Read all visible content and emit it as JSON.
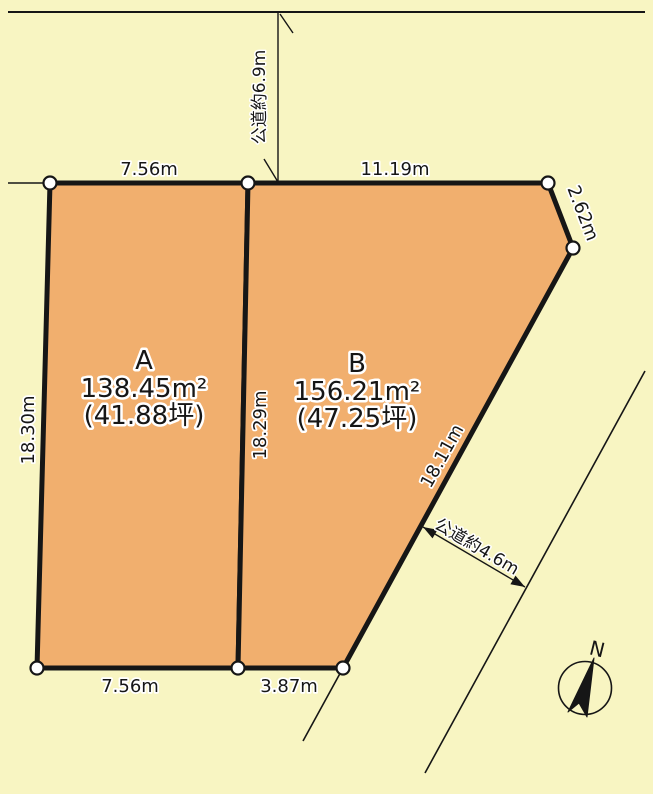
{
  "colors": {
    "background": "#F8F5C2",
    "parcel_fill": "#F1AF6E",
    "line": "#161616",
    "corner_marker": "#FFFFFF"
  },
  "parcels": [
    {
      "label": "A",
      "area_sqm": "138.45m²",
      "area_tsubo": "(41.88坪)"
    },
    {
      "label": "B",
      "area_sqm": "156.21m²",
      "area_tsubo": "(47.25坪)"
    }
  ],
  "dimensions": {
    "a_top_width": "7.56m",
    "b_top_width": "11.19m",
    "corner_cut": "2.62m",
    "a_left_depth": "18.30m",
    "shared_boundary_depth": "18.29m",
    "b_diagonal_depth": "18.11m",
    "a_bottom_width": "7.56m",
    "b_bottom_width": "3.87m"
  },
  "roads": {
    "north_road": "公道約6.9m",
    "southeast_road": "公道約4.6m"
  },
  "compass": {
    "north_label": "N"
  }
}
